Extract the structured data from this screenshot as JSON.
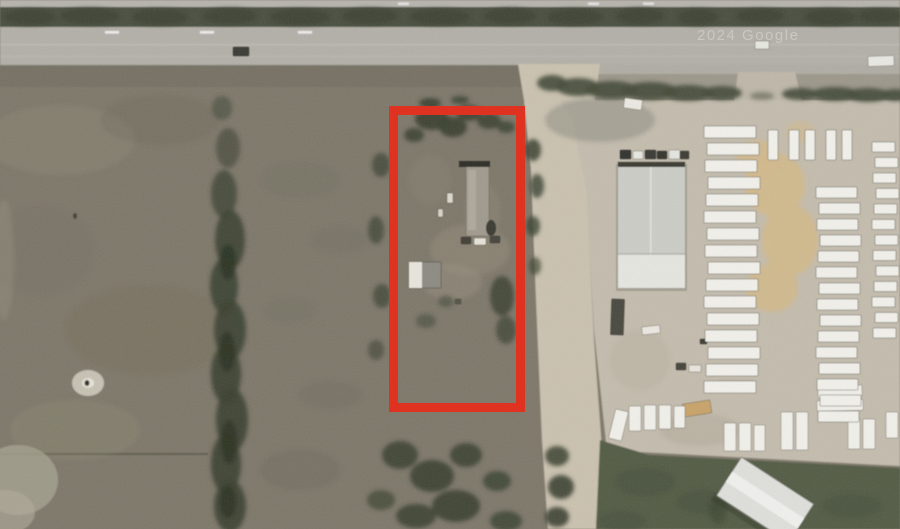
{
  "view": {
    "description": "aerial-satellite-photo-with-parcel-outline",
    "watermark": "2024 Google"
  },
  "colors": {
    "boundary_red": "#e03220",
    "highway_gray": "#b3b0a8",
    "median_green": "#4a5040",
    "field_olive": "#7e786b",
    "dirt_road_tan": "#cbc2b0",
    "lot_beige": "#c4bdae",
    "sand_tan": "#d2b98c",
    "grass_green": "#535c45",
    "trailer_white": "#f2f0ea",
    "tree_dark_green": "#3a4130",
    "watermark_white": "#ffffff"
  },
  "annotations": {
    "property_boundary": {
      "shape": "rectangle",
      "x": 389,
      "y": 106,
      "width": 136,
      "height": 306,
      "stroke_width": 9,
      "color": "#e03220"
    }
  },
  "scene": {
    "blobs": [
      [
        60,
        140,
        75,
        35,
        0.22,
        "#9a947f"
      ],
      [
        160,
        120,
        60,
        25,
        0.18,
        "#5e5b4b"
      ],
      [
        40,
        250,
        55,
        45,
        0.15,
        "#6a6555"
      ],
      [
        150,
        330,
        85,
        45,
        0.18,
        "#67624f"
      ],
      [
        75,
        430,
        65,
        30,
        0.2,
        "#9a947f"
      ],
      [
        4,
        260,
        10,
        60,
        0.3,
        "#a09a88"
      ],
      [
        300,
        180,
        40,
        18,
        0.2,
        "#6b685a"
      ],
      [
        340,
        240,
        30,
        14,
        0.22,
        "#6b685a"
      ],
      [
        290,
        310,
        26,
        12,
        0.2,
        "#6b685a"
      ],
      [
        330,
        395,
        32,
        14,
        0.22,
        "#666252"
      ],
      [
        300,
        470,
        40,
        20,
        0.2,
        "#5f5c4a"
      ],
      [
        470,
        250,
        40,
        26,
        0.5,
        "#948b7a"
      ],
      [
        452,
        282,
        30,
        18,
        0.45,
        "#9a9181"
      ],
      [
        483,
        212,
        18,
        30,
        0.4,
        "#8f8677"
      ],
      [
        430,
        180,
        22,
        26,
        0.35,
        "#8a8273"
      ],
      [
        600,
        120,
        55,
        22,
        0.5,
        "#8a897b"
      ],
      [
        640,
        360,
        30,
        30,
        0.35,
        "#b5ad9b"
      ],
      [
        700,
        430,
        40,
        16,
        0.3,
        "#a49c8a"
      ],
      [
        775,
        185,
        30,
        32,
        0.95,
        "#d2b98c"
      ],
      [
        790,
        240,
        28,
        36,
        0.95,
        "#d2b98c"
      ],
      [
        772,
        288,
        26,
        24,
        0.9,
        "#d2b98c"
      ],
      [
        758,
        158,
        22,
        18,
        0.85,
        "#d2b98c"
      ],
      [
        800,
        132,
        14,
        11,
        0.6,
        "#d2b98c"
      ],
      [
        30,
        17,
        26,
        8,
        0.9,
        "#3e4434"
      ],
      [
        90,
        16,
        30,
        8,
        0.9,
        "#3e4434"
      ],
      [
        160,
        17,
        28,
        8,
        0.9,
        "#3e4434"
      ],
      [
        230,
        16,
        27,
        8,
        0.9,
        "#3e4434"
      ],
      [
        300,
        17,
        30,
        8,
        0.9,
        "#3e4434"
      ],
      [
        370,
        16,
        28,
        8,
        0.9,
        "#3e4434"
      ],
      [
        440,
        17,
        30,
        8,
        0.9,
        "#3e4434"
      ],
      [
        510,
        16,
        26,
        8,
        0.9,
        "#3e4434"
      ],
      [
        575,
        17,
        28,
        8,
        0.9,
        "#3e4434"
      ],
      [
        640,
        16,
        24,
        8,
        0.9,
        "#3e4434"
      ],
      [
        698,
        17,
        20,
        8,
        0.9,
        "#3e4434"
      ],
      [
        760,
        16,
        24,
        7,
        0.9,
        "#3e4434"
      ],
      [
        830,
        17,
        26,
        8,
        0.9,
        "#3e4434"
      ],
      [
        880,
        16,
        22,
        7,
        0.9,
        "#3e4434"
      ],
      [
        552,
        83,
        15,
        8,
        0.92,
        "#454c39"
      ],
      [
        578,
        87,
        22,
        9,
        0.92,
        "#454c39"
      ],
      [
        612,
        90,
        26,
        9,
        0.92,
        "#454c39"
      ],
      [
        650,
        91,
        28,
        9,
        0.92,
        "#454c39"
      ],
      [
        688,
        93,
        26,
        8,
        0.92,
        "#454c39"
      ],
      [
        722,
        93,
        20,
        7,
        0.92,
        "#454c39"
      ],
      [
        800,
        94,
        18,
        6,
        0.92,
        "#454c39"
      ],
      [
        835,
        94,
        24,
        7,
        0.92,
        "#454c39"
      ],
      [
        868,
        95,
        22,
        7,
        0.92,
        "#454c39"
      ],
      [
        895,
        95,
        14,
        6,
        0.92,
        "#454c39"
      ],
      [
        762,
        96,
        12,
        4,
        0.5,
        "#454c39"
      ],
      [
        222,
        108,
        10,
        12,
        0.5
      ],
      [
        228,
        148,
        12,
        20,
        0.6
      ],
      [
        224,
        194,
        13,
        24,
        0.75
      ],
      [
        230,
        240,
        15,
        30,
        0.85
      ],
      [
        224,
        286,
        14,
        28,
        0.88
      ],
      [
        230,
        330,
        16,
        30,
        0.88
      ],
      [
        226,
        374,
        15,
        30,
        0.9
      ],
      [
        232,
        420,
        16,
        32,
        0.9
      ],
      [
        226,
        464,
        15,
        30,
        0.9
      ],
      [
        230,
        506,
        16,
        26,
        0.9
      ],
      [
        228,
        262,
        8,
        18,
        0.9,
        "#2c3424"
      ],
      [
        227,
        352,
        8,
        20,
        0.9,
        "#2c3424"
      ],
      [
        229,
        442,
        8,
        22,
        0.9,
        "#2c3424"
      ],
      [
        228,
        502,
        8,
        16,
        0.9,
        "#2c3424"
      ],
      [
        432,
        119,
        17,
        11,
        0.92
      ],
      [
        453,
        127,
        14,
        10,
        0.92
      ],
      [
        469,
        113,
        12,
        8,
        0.9
      ],
      [
        489,
        121,
        12,
        8,
        0.85
      ],
      [
        414,
        135,
        10,
        7,
        0.85
      ],
      [
        506,
        127,
        9,
        6,
        0.8
      ],
      [
        430,
        103,
        11,
        5,
        0.9
      ],
      [
        460,
        100,
        9,
        4,
        0.8
      ],
      [
        533,
        150,
        8,
        11,
        0.85
      ],
      [
        537,
        186,
        7,
        12,
        0.8
      ],
      [
        533,
        226,
        7,
        10,
        0.8
      ],
      [
        535,
        266,
        6,
        9,
        0.7
      ],
      [
        381,
        165,
        9,
        12,
        0.72
      ],
      [
        376,
        230,
        8,
        14,
        0.68
      ],
      [
        382,
        296,
        9,
        12,
        0.68
      ],
      [
        376,
        350,
        8,
        10,
        0.6
      ],
      [
        502,
        296,
        12,
        20,
        0.82
      ],
      [
        506,
        330,
        10,
        14,
        0.72
      ],
      [
        446,
        301,
        8,
        6,
        0.5
      ],
      [
        426,
        321,
        10,
        7,
        0.5
      ],
      [
        400,
        455,
        18,
        14,
        0.85
      ],
      [
        432,
        476,
        22,
        16,
        0.9
      ],
      [
        466,
        455,
        16,
        12,
        0.85
      ],
      [
        456,
        506,
        24,
        16,
        0.9
      ],
      [
        497,
        481,
        14,
        10,
        0.8
      ],
      [
        416,
        516,
        20,
        12,
        0.85
      ],
      [
        381,
        500,
        14,
        10,
        0.7
      ],
      [
        506,
        521,
        16,
        10,
        0.8
      ],
      [
        557,
        456,
        12,
        10,
        0.85
      ],
      [
        561,
        487,
        13,
        12,
        0.9
      ],
      [
        557,
        517,
        12,
        10,
        0.9
      ],
      [
        645,
        482,
        30,
        14,
        0.5,
        "#46503c"
      ],
      [
        703,
        502,
        26,
        12,
        0.5,
        "#46503c"
      ],
      [
        852,
        506,
        30,
        12,
        0.45,
        "#46503c"
      ],
      [
        622,
        521,
        24,
        10,
        0.5,
        "#46503c"
      ],
      [
        718,
        509,
        9,
        15,
        0.55,
        "#39412e"
      ]
    ],
    "trailer_rows": [
      {
        "x": 706,
        "y": 126,
        "w": 55,
        "h": 12,
        "dy": 17,
        "count": 16
      },
      {
        "x": 818,
        "y": 187,
        "w": 44,
        "h": 11,
        "dy": 16,
        "count": 15
      },
      {
        "x": 874,
        "y": 142,
        "w": 26,
        "h": 10,
        "dy": 15.5,
        "count": 13
      },
      {
        "x": 770,
        "y": 130,
        "w": 13,
        "h": 30,
        "dx": 18,
        "count": 5
      }
    ],
    "items": [
      {
        "x": 233,
        "y": 47,
        "w": 16,
        "h": 9,
        "fill": "#3a3a36",
        "name": "car-on-highway"
      },
      {
        "x": 755,
        "y": 41,
        "w": 14,
        "h": 8,
        "fill": "#e8e8e2",
        "name": "car-on-highway"
      },
      {
        "x": 868,
        "y": 56,
        "w": 26,
        "h": 10,
        "rot": -2,
        "fill": "#e9e8e2",
        "name": "truck-on-highway"
      },
      {
        "x": 624,
        "y": 99,
        "w": 18,
        "h": 10,
        "rot": 8,
        "fill": "#eceae2",
        "name": "white-van"
      },
      {
        "x": 620,
        "y": 150,
        "w": 11,
        "h": 9,
        "fill": "#32322e",
        "name": "parked-car"
      },
      {
        "x": 633,
        "y": 151,
        "w": 10,
        "h": 8,
        "fill": "#e8e8e2",
        "name": "parked-car"
      },
      {
        "x": 645,
        "y": 150,
        "w": 11,
        "h": 9,
        "fill": "#3a3a34",
        "name": "parked-car"
      },
      {
        "x": 657,
        "y": 151,
        "w": 10,
        "h": 8,
        "fill": "#35352f",
        "name": "parked-car"
      },
      {
        "x": 669,
        "y": 150,
        "w": 11,
        "h": 9,
        "fill": "#e6e6e0",
        "name": "parked-car"
      },
      {
        "x": 680,
        "y": 151,
        "w": 9,
        "h": 8,
        "fill": "#3c3c36",
        "name": "parked-car"
      },
      {
        "x": 611,
        "y": 299,
        "w": 13,
        "h": 36,
        "rot": 2,
        "fill": "#4a4a40",
        "name": "dark-trailer"
      },
      {
        "x": 642,
        "y": 326,
        "w": 18,
        "h": 8,
        "rot": -6,
        "fill": "#eae8e0",
        "name": "white-truck"
      },
      {
        "x": 676,
        "y": 363,
        "w": 10,
        "h": 7,
        "fill": "#44443c",
        "name": "vehicle"
      },
      {
        "x": 689,
        "y": 365,
        "w": 12,
        "h": 7,
        "fill": "#e8e6de",
        "name": "vehicle"
      },
      {
        "x": 700,
        "y": 339,
        "w": 7,
        "h": 5,
        "fill": "#3c3c34",
        "name": "vehicle"
      },
      {
        "x": 683,
        "y": 402,
        "w": 28,
        "h": 13,
        "rot": -9,
        "fill": "#c9a36b",
        "name": "tan-shed"
      },
      {
        "x": 461,
        "y": 237,
        "w": 10,
        "h": 7,
        "fill": "#3f3f39",
        "name": "vehicle-on-parcel"
      },
      {
        "x": 474,
        "y": 238,
        "w": 12,
        "h": 7,
        "fill": "#e6e4da",
        "name": "vehicle-on-parcel"
      },
      {
        "x": 490,
        "y": 236,
        "w": 10,
        "h": 7,
        "fill": "#44443e",
        "name": "vehicle-on-parcel"
      },
      {
        "x": 447,
        "y": 193,
        "w": 6,
        "h": 10,
        "fill": "#ddd9cc",
        "name": "debris"
      },
      {
        "x": 438,
        "y": 209,
        "w": 5,
        "h": 8,
        "fill": "#d8d4c6",
        "name": "debris"
      },
      {
        "x": 455,
        "y": 299,
        "w": 6,
        "h": 5,
        "fill": "#55554b",
        "name": "debris"
      },
      {
        "x": 612,
        "y": 410,
        "w": 13,
        "h": 30,
        "rot": 14,
        "name": "rv-trailer"
      },
      {
        "x": 629,
        "y": 406,
        "w": 12,
        "h": 25,
        "name": "rv-trailer"
      },
      {
        "x": 644,
        "y": 405,
        "w": 12,
        "h": 25,
        "name": "rv-trailer"
      },
      {
        "x": 659,
        "y": 405,
        "w": 12,
        "h": 24,
        "name": "rv-trailer"
      },
      {
        "x": 674,
        "y": 406,
        "w": 11,
        "h": 22,
        "name": "rv-trailer"
      },
      {
        "x": 724,
        "y": 423,
        "w": 12,
        "h": 28,
        "name": "rv-trailer"
      },
      {
        "x": 739,
        "y": 423,
        "w": 12,
        "h": 28,
        "name": "rv-trailer"
      },
      {
        "x": 754,
        "y": 425,
        "w": 11,
        "h": 26,
        "name": "rv-trailer"
      },
      {
        "x": 781,
        "y": 412,
        "w": 12,
        "h": 38,
        "name": "rv-trailer"
      },
      {
        "x": 796,
        "y": 412,
        "w": 12,
        "h": 38,
        "name": "rv-trailer"
      },
      {
        "x": 818,
        "y": 386,
        "w": 44,
        "h": 11,
        "rot": -3,
        "name": "rv-trailer"
      },
      {
        "x": 817,
        "y": 400,
        "w": 46,
        "h": 11,
        "rot": -2,
        "name": "rv-trailer"
      },
      {
        "x": 719,
        "y": 381,
        "w": 34,
        "h": 10,
        "name": "rv-trailer"
      },
      {
        "x": 848,
        "y": 419,
        "w": 12,
        "h": 30,
        "name": "rv-trailer"
      },
      {
        "x": 863,
        "y": 419,
        "w": 12,
        "h": 30,
        "name": "rv-trailer"
      },
      {
        "x": 886,
        "y": 412,
        "w": 12,
        "h": 26,
        "name": "rv-trailer"
      }
    ]
  }
}
